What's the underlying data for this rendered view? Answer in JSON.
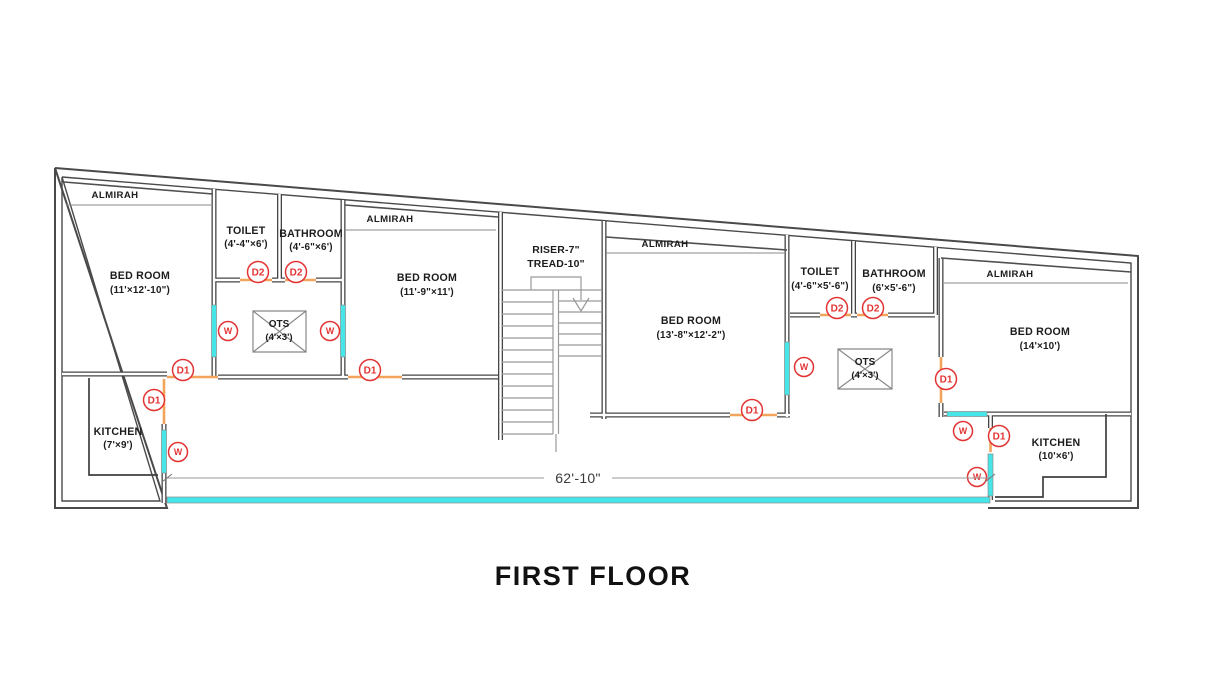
{
  "title": "FIRST FLOOR",
  "dimension_label": "62'-10\"",
  "markers": {
    "d1": "D1",
    "d2": "D2",
    "w": "W"
  },
  "rooms": {
    "almirah_label": "ALMIRAH",
    "bedroom1": {
      "name": "BED ROOM",
      "size": "(11'×12'-10\")"
    },
    "toilet1": {
      "name": "TOILET",
      "size": "(4'-4\"×6')"
    },
    "bathroom1": {
      "name": "BATHROOM",
      "size": "(4'-6\"×6')"
    },
    "ots1": {
      "name": "OTS",
      "size": "(4'×3')"
    },
    "bedroom2": {
      "name": "BED ROOM",
      "size": "(11'-9\"×11')"
    },
    "stair": {
      "line1": "RISER-7\"",
      "line2": "TREAD-10\""
    },
    "bedroom3": {
      "name": "BED ROOM",
      "size": "(13'-8\"×12'-2\")"
    },
    "toilet2": {
      "name": "TOILET",
      "size": "(4'-6\"×5'-6\")"
    },
    "bathroom2": {
      "name": "BATHROOM",
      "size": "(6'×5'-6\")"
    },
    "ots2": {
      "name": "OTS",
      "size": "(4'×3')"
    },
    "bedroom4": {
      "name": "BED ROOM",
      "size": "(14'×10')"
    },
    "kitchen_left": {
      "name": "KITCHEN",
      "size": "(7'×9')"
    },
    "kitchen_right": {
      "name": "KITCHEN",
      "size": "(10'×6')"
    }
  },
  "colors": {
    "wall": "#454545",
    "window": "#46e6e8",
    "door": "#f2a45c",
    "marker": "#e23333",
    "gray_line": "#999999",
    "text": "#1c1c1c",
    "background": "#ffffff"
  }
}
